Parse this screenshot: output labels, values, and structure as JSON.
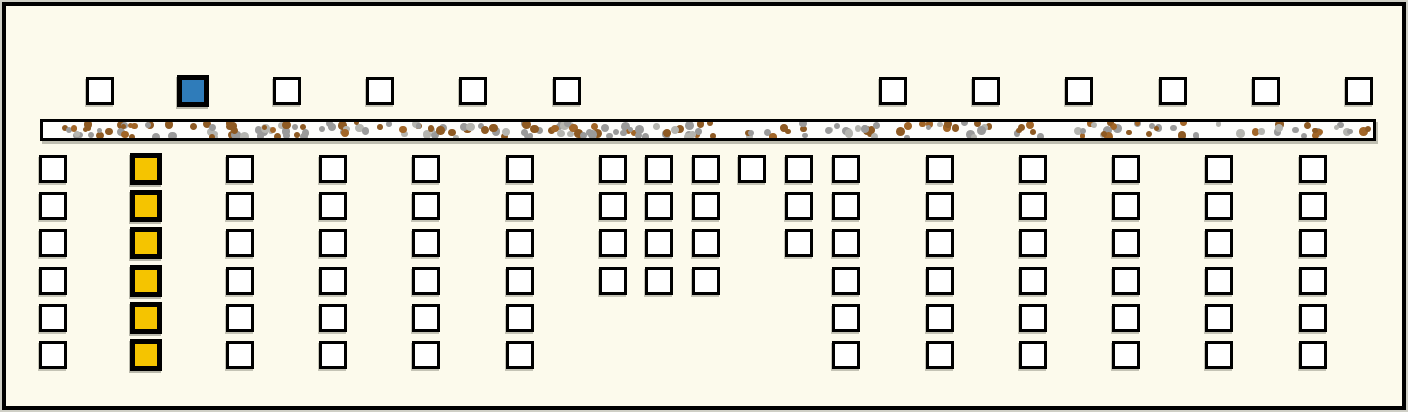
{
  "scene": {
    "background": "#FCFAEC",
    "frame_color": "#000000",
    "width": 1408,
    "height": 412
  },
  "palette": {
    "square_fill": "#FFFFFF",
    "square_border": "#000000",
    "selected_blue": "#2F7CBA",
    "selected_yellow": "#F5C400",
    "road_fill": "#FDFDFB",
    "gravel_colors": [
      "#9A9A9A",
      "#8E5A23",
      "#B5B5B0",
      "#A26628"
    ]
  },
  "top_row": {
    "y": 75,
    "square_size": 28,
    "squares": [
      {
        "x": 84,
        "state": "default"
      },
      {
        "x": 177,
        "state": "selected-blue"
      },
      {
        "x": 271,
        "state": "default"
      },
      {
        "x": 364,
        "state": "default"
      },
      {
        "x": 457,
        "state": "default"
      },
      {
        "x": 551,
        "state": "default"
      },
      {
        "x": 877,
        "state": "default"
      },
      {
        "x": 970,
        "state": "default"
      },
      {
        "x": 1063,
        "state": "default"
      },
      {
        "x": 1157,
        "state": "default"
      },
      {
        "x": 1250,
        "state": "default"
      },
      {
        "x": 1343,
        "state": "default"
      }
    ]
  },
  "road_bar": {
    "x": 38,
    "y": 117,
    "width": 1336,
    "height": 22,
    "dot_count": 240,
    "dot_min_size": 5,
    "dot_max_size": 9,
    "seed": 1337
  },
  "grid": {
    "row_ys": [
      153,
      190,
      227,
      265,
      302,
      339
    ],
    "square_size": 28,
    "columns": [
      {
        "x": 37,
        "rows": [
          1,
          2,
          3,
          4,
          5,
          6
        ],
        "state": "default"
      },
      {
        "x": 130,
        "rows": [
          1,
          2,
          3,
          4,
          5,
          6
        ],
        "state": "selected-yellow"
      },
      {
        "x": 224,
        "rows": [
          1,
          2,
          3,
          4,
          5,
          6
        ],
        "state": "default"
      },
      {
        "x": 317,
        "rows": [
          1,
          2,
          3,
          4,
          5,
          6
        ],
        "state": "default"
      },
      {
        "x": 410,
        "rows": [
          1,
          2,
          3,
          4,
          5,
          6
        ],
        "state": "default"
      },
      {
        "x": 504,
        "rows": [
          1,
          2,
          3,
          4,
          5,
          6
        ],
        "state": "default"
      },
      {
        "x": 597,
        "rows": [
          1,
          2,
          3,
          4
        ],
        "state": "default"
      },
      {
        "x": 643,
        "rows": [
          1,
          2,
          3,
          4
        ],
        "state": "default"
      },
      {
        "x": 690,
        "rows": [
          1,
          2,
          3,
          4
        ],
        "state": "default"
      },
      {
        "x": 736,
        "rows": [
          1
        ],
        "state": "default"
      },
      {
        "x": 783,
        "rows": [
          1,
          2,
          3
        ],
        "state": "default"
      },
      {
        "x": 830,
        "rows": [
          1,
          2,
          3,
          4,
          5,
          6
        ],
        "state": "default"
      },
      {
        "x": 924,
        "rows": [
          1,
          2,
          3,
          4,
          5,
          6
        ],
        "state": "default"
      },
      {
        "x": 1017,
        "rows": [
          1,
          2,
          3,
          4,
          5,
          6
        ],
        "state": "default"
      },
      {
        "x": 1110,
        "rows": [
          1,
          2,
          3,
          4,
          5,
          6
        ],
        "state": "default"
      },
      {
        "x": 1203,
        "rows": [
          1,
          2,
          3,
          4,
          5,
          6
        ],
        "state": "default"
      },
      {
        "x": 1297,
        "rows": [
          1,
          2,
          3,
          4,
          5,
          6
        ],
        "state": "default"
      }
    ]
  }
}
